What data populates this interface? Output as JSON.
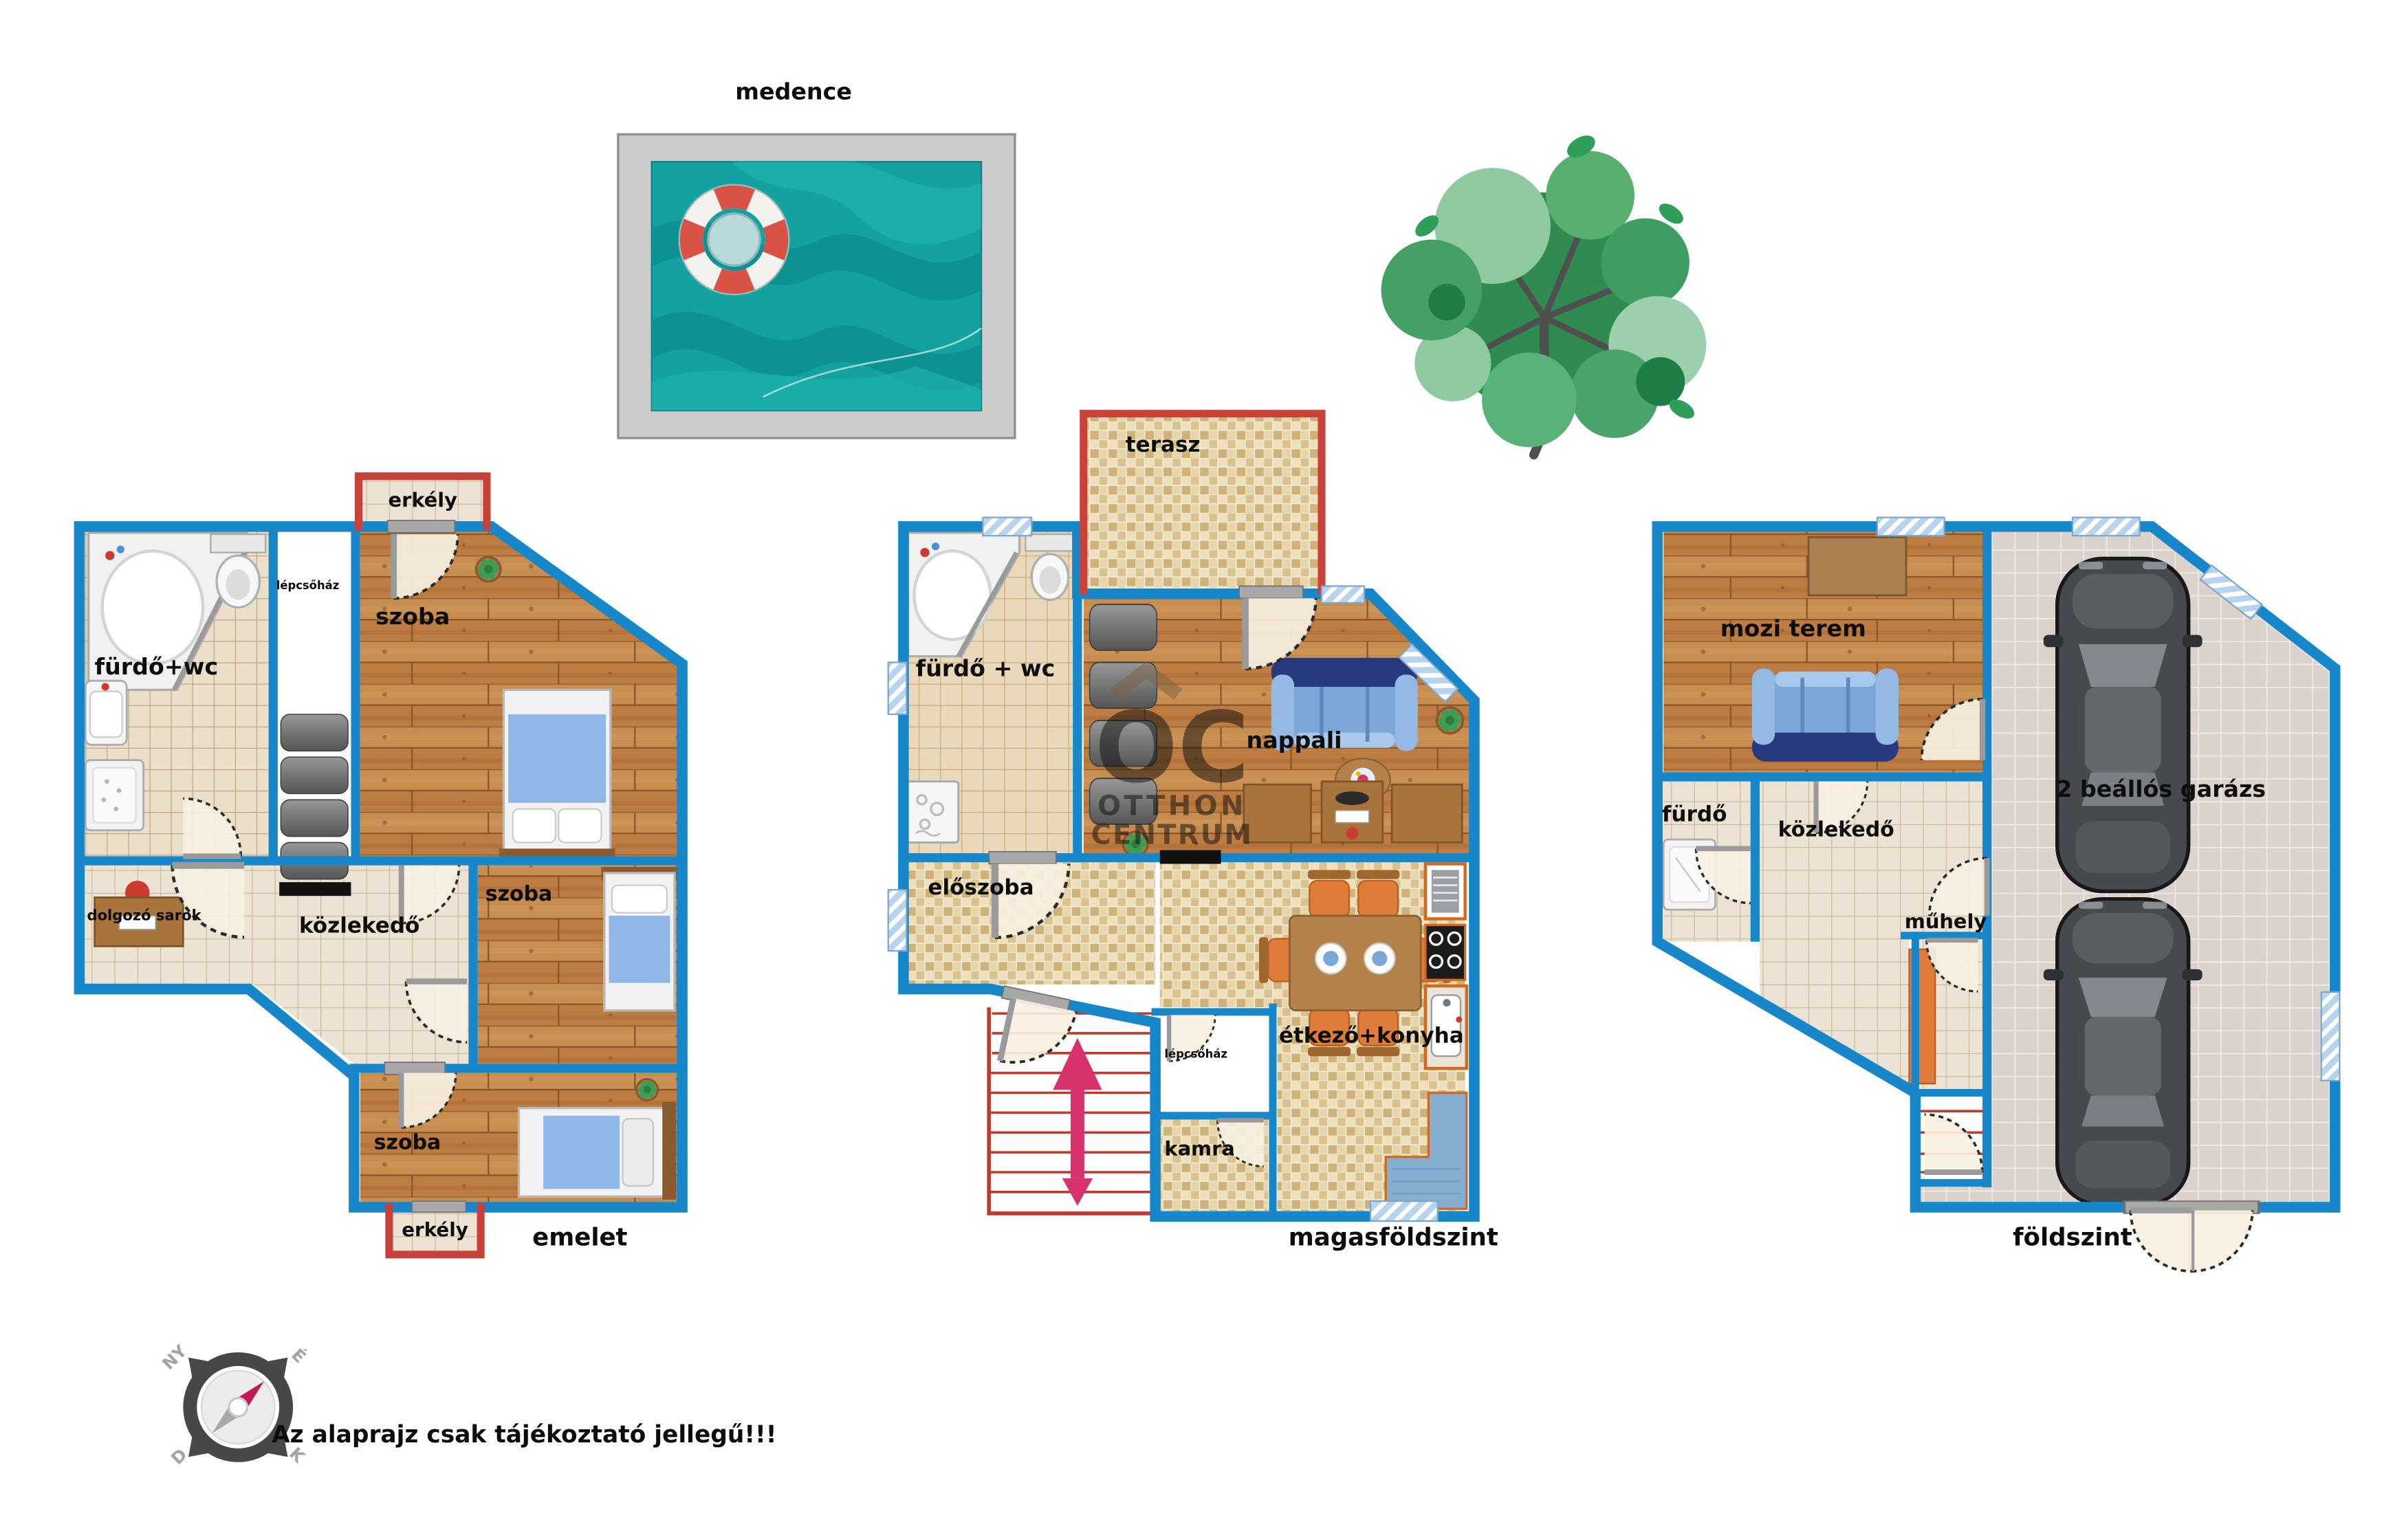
{
  "disclaimer": "Az alaprajz csak tájékoztató jellegű!!!",
  "pool": {
    "label": "medence"
  },
  "watermark": {
    "line1": "OC",
    "line2": "OTTHON",
    "line3": "CENTRUM"
  },
  "compass": {
    "nw": "NY",
    "ne": "É",
    "sw": "D",
    "se": "K"
  },
  "colors": {
    "wall_blue": "#1787c9",
    "balcony_red": "#c8413b",
    "pool_water": "#13a1a1",
    "wood_floor": "#c4854a",
    "arrow_pink": "#d6336c",
    "watermark_brown": "#7d6246"
  },
  "floors": {
    "emelet": {
      "name": "emelet",
      "balcony_top": "erkély",
      "bathroom": "fürdő+wc",
      "staircase": "lépcsőház",
      "bedroom_top": "szoba",
      "work_corner": "dolgozó sarok",
      "hallway": "közlekedő",
      "bedroom_mid": "szoba",
      "bedroom_bottom": "szoba",
      "balcony_bottom": "erkély"
    },
    "magasfoldszint": {
      "name": "magasföldszint",
      "terrace": "terasz",
      "bathroom": "fürdő + wc",
      "living_room": "nappali",
      "entry_hall": "előszoba",
      "staircase": "lépcsőház",
      "pantry": "kamra",
      "dining_kitchen": "étkező+konyha"
    },
    "foldszint": {
      "name": "földszint",
      "cinema": "mozi terem",
      "bathroom": "fürdő",
      "hallway": "közlekedő",
      "workshop": "műhely",
      "garage": "2 beállós garázs"
    }
  }
}
